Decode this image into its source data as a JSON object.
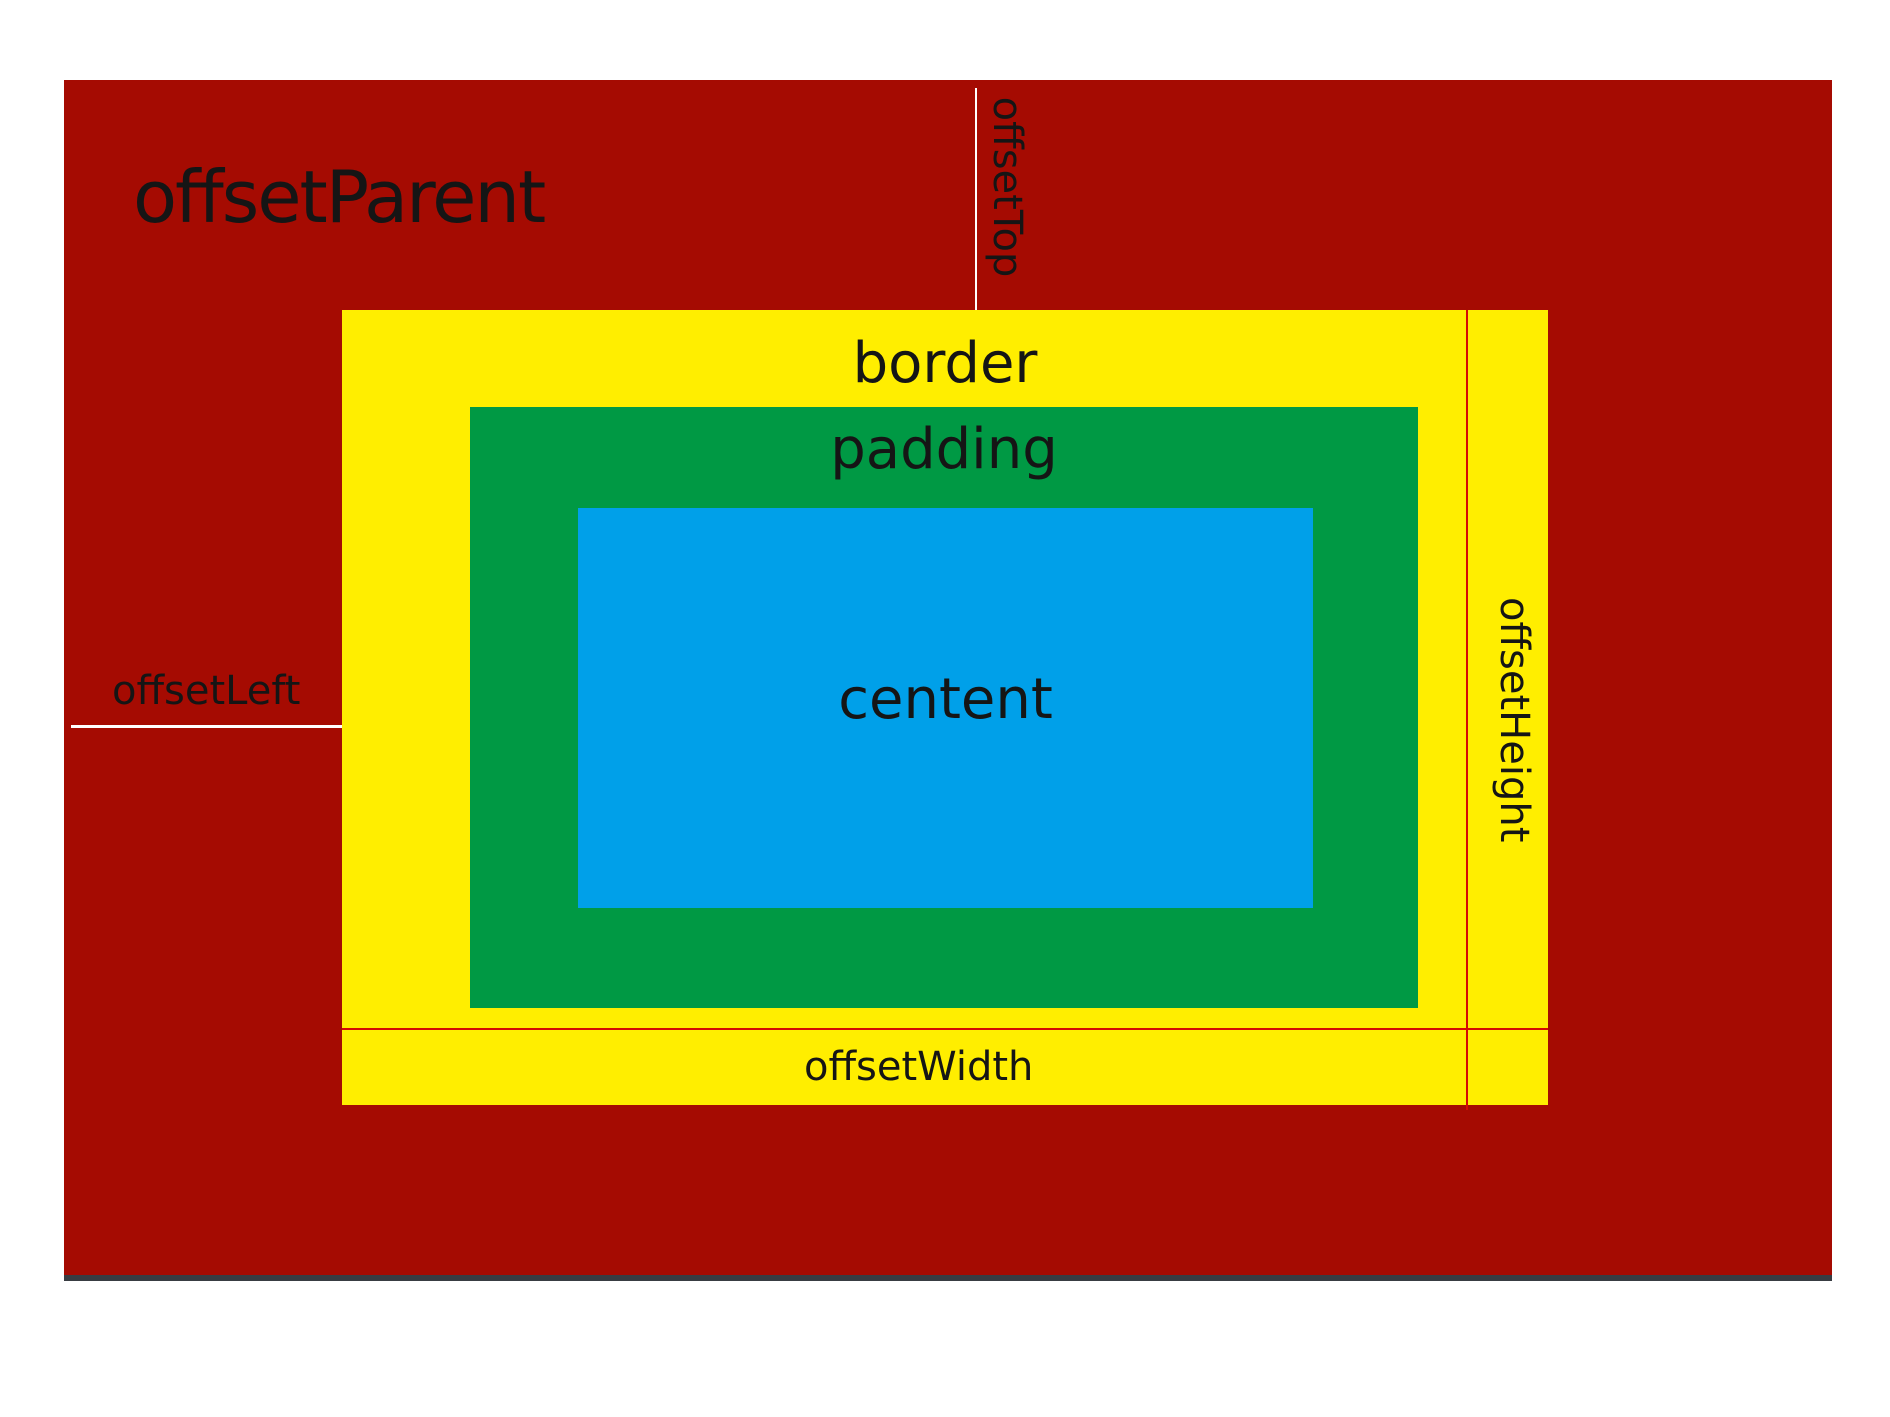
{
  "diagram": {
    "labels": {
      "offset_parent": "offsetParent",
      "border": "border",
      "padding": "padding",
      "content": "centent",
      "offset_top": "offsetTop",
      "offset_left": "offsetLeft",
      "offset_width": "offsetWidth",
      "offset_height": "offsetHeight"
    },
    "colors": {
      "page_bg": "#ffffff",
      "offset_parent_bg": "#a50b02",
      "border_bg": "#ffee00",
      "padding_bg": "#009944",
      "content_bg": "#00a0e9",
      "marker_line_red": "#d40b04",
      "marker_line_white": "#ffffff",
      "base_line": "#383c42",
      "label_text": "#151515"
    }
  }
}
